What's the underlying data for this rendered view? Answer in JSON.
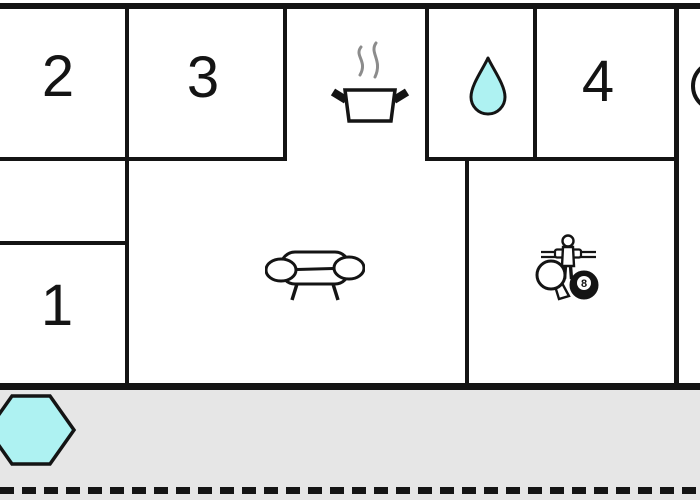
{
  "floorplan": {
    "title": "apartment-floor-plan",
    "rooms": [
      {
        "id": "room-2",
        "label": "2"
      },
      {
        "id": "room-3",
        "label": "3"
      },
      {
        "id": "room-4",
        "label": "4"
      },
      {
        "id": "room-1",
        "label": "1"
      }
    ],
    "icons": {
      "kitchen": "cooking-pot-with-steam",
      "bathroom": "water-drop",
      "living_room": "sofa",
      "game_room": "foosball-player, ping-pong-paddle, eight-ball",
      "terrace": "hexagonal-hot-tub",
      "right_edge": "partial-circle-cut-off"
    },
    "eight_ball_label": "8",
    "colors": {
      "wall": "#141414",
      "cyan_fill": "#aef2f2",
      "terrace_gray": "#e6e6e6",
      "steam_gray": "#8c8c8c",
      "background": "#ffffff"
    }
  }
}
